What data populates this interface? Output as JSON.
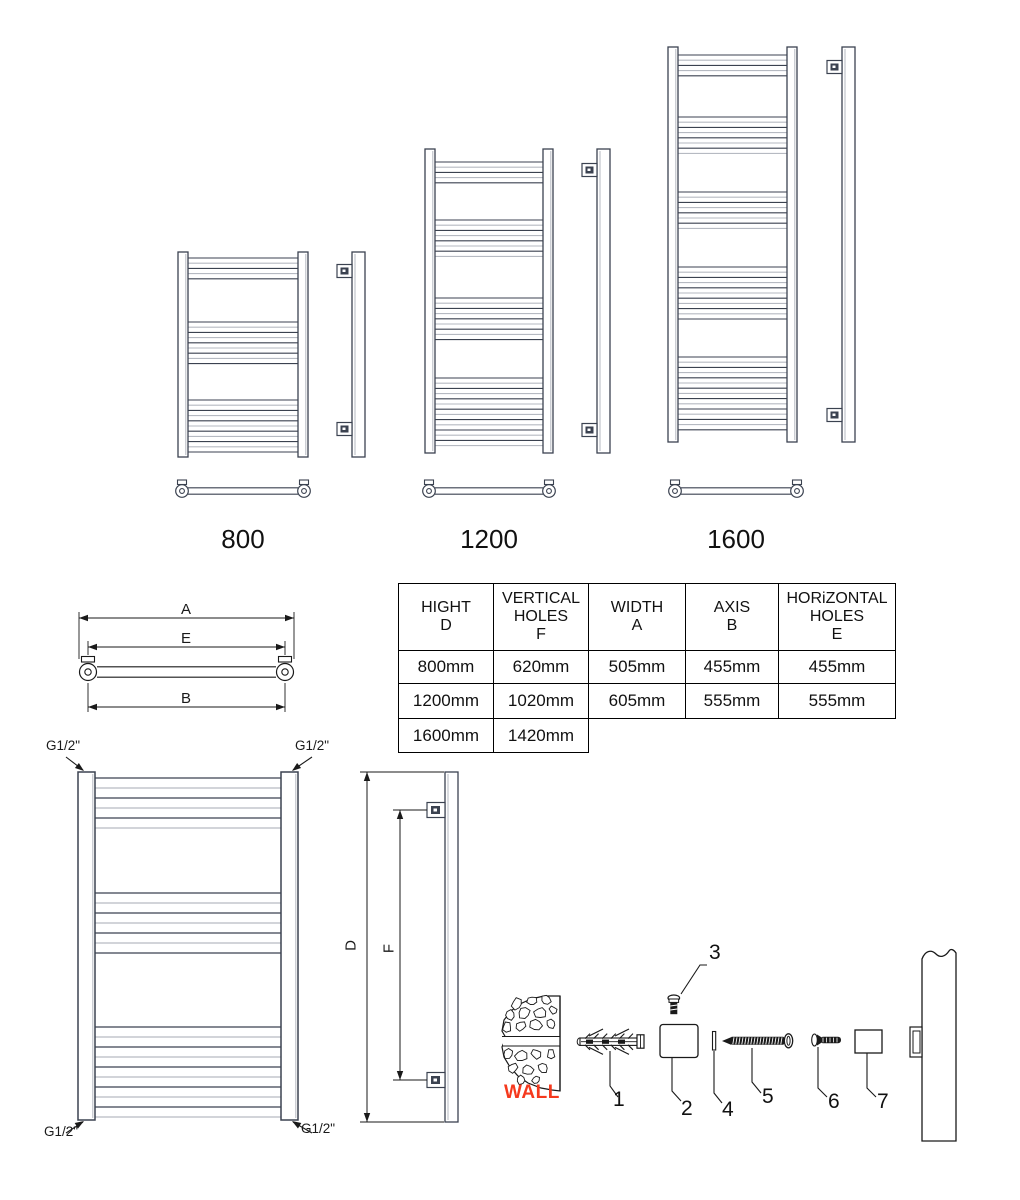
{
  "colors": {
    "line_dark": "#3b4250",
    "line_light": "#b6bac2",
    "ink": "#1a1a1a",
    "wall_label": "#f5391d"
  },
  "radiators": [
    {
      "label": "800"
    },
    {
      "label": "1200"
    },
    {
      "label": "1600"
    }
  ],
  "table": {
    "headers": [
      "HIGHT\nD",
      "VERTICAL\nHOLES\nF",
      "WIDTH\nA",
      "AXIS\nB",
      "HORiZONTAL\nHOLES\nE"
    ],
    "rows": [
      [
        "800mm",
        "620mm",
        "505mm",
        "455mm",
        "455mm"
      ],
      [
        "1200mm",
        "1020mm",
        "605mm",
        "555mm",
        "555mm"
      ],
      [
        "1600mm",
        "1420mm"
      ]
    ]
  },
  "dimension_labels": {
    "width_overall": "A",
    "horizontal_holes": "E",
    "axis": "B",
    "height": "D",
    "vertical_holes": "F"
  },
  "thread_label": "G1/2\"",
  "wall_label": "WALL",
  "part_numbers": [
    "1",
    "2",
    "3",
    "4",
    "5",
    "6",
    "7"
  ]
}
